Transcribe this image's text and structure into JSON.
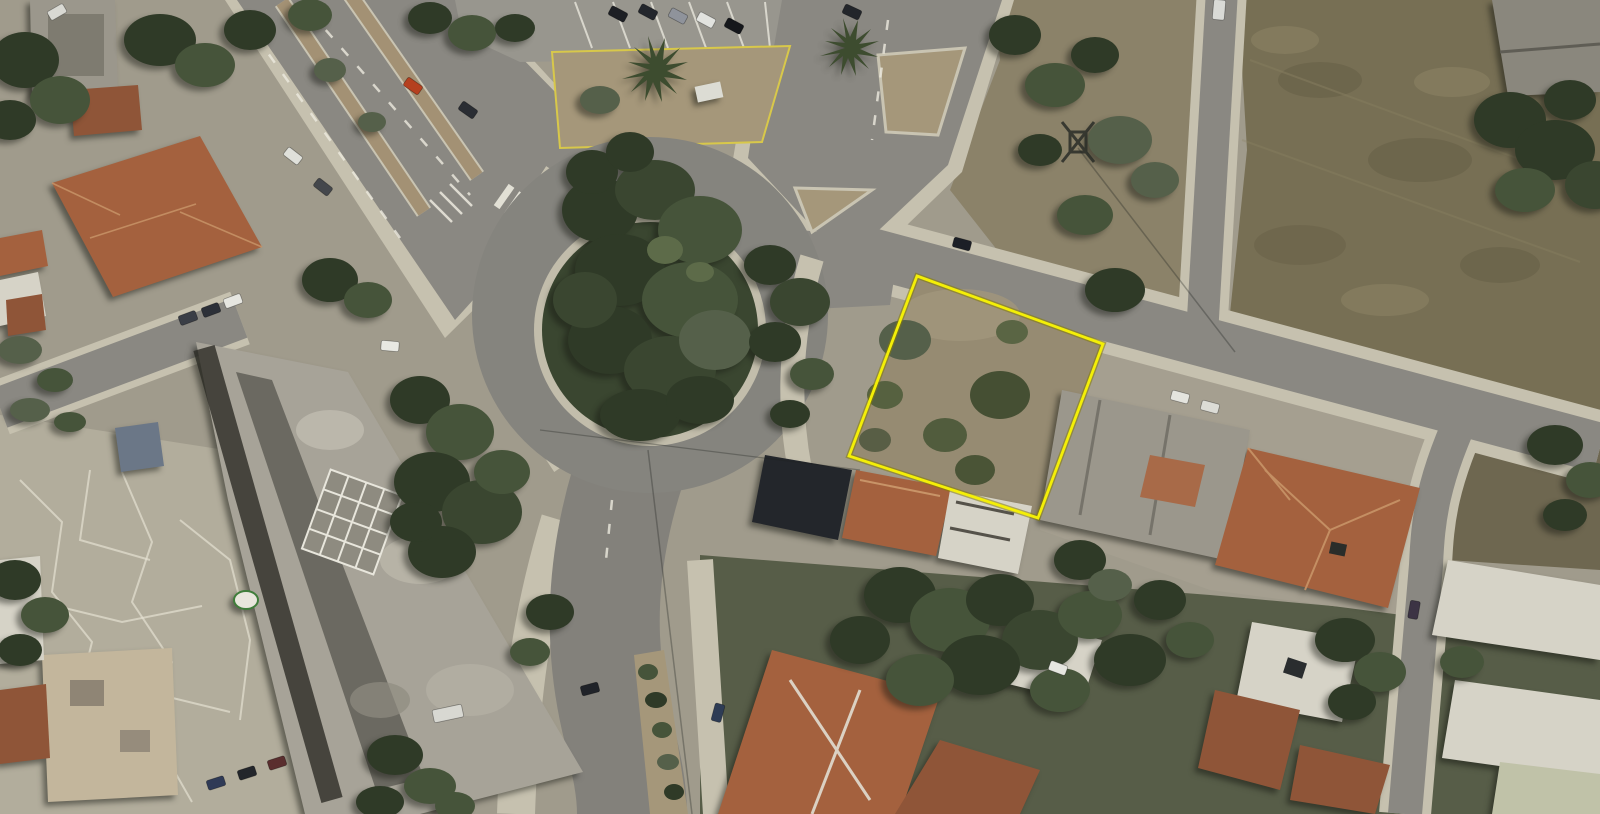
{
  "view": {
    "type": "satellite-aerial-photo",
    "description": "Aerial satellite view of an urban roundabout junction with a vacant land plot highlighted by a yellow boundary line",
    "width_px": 1600,
    "height_px": 814
  },
  "annotation": {
    "plot_boundary": {
      "label": "highlighted vacant land plot",
      "shape": "quadrilateral",
      "points": "917,276 1103,344 1038,518 849,456",
      "stroke_color": "#f4ef07",
      "casing_color": "#857c06",
      "style": "solid-bright-yellow"
    }
  },
  "features": [
    {
      "id": "roundabout",
      "label": "tree-covered roundabout island"
    },
    {
      "id": "highlighted-plot",
      "label": "vacant dirt plot with scattered shrubs outlined in yellow"
    },
    {
      "id": "dry-field",
      "label": "large dry open field, north-east corner"
    },
    {
      "id": "construction-building",
      "label": "large roofless building under construction, south-west"
    },
    {
      "id": "paved-plaza",
      "label": "cracked paved plaza, south-west"
    },
    {
      "id": "boulevard",
      "label": "divided boulevard with planted medians, north-west"
    },
    {
      "id": "north-avenue",
      "label": "wide avenue entering from the north"
    },
    {
      "id": "east-road",
      "label": "road running east past the plot"
    },
    {
      "id": "south-road",
      "label": "road running south with planted median"
    },
    {
      "id": "parking-bays",
      "label": "angled parking bays with cars, top centre"
    },
    {
      "id": "residential-blocks",
      "label": "terracotta-roofed and flat white-roofed houses"
    },
    {
      "id": "parked-cars",
      "label": "cars parked along streets and in yards"
    }
  ],
  "palette": {
    "road": "#8a8882",
    "road_light": "#98968e",
    "sidewalk": "#c6c1af",
    "plaza": "#b2ad9c",
    "field": "#776f54",
    "scrub": "#8b8269",
    "plot_ground": "#968b72",
    "tree_dark": "#2f3a27",
    "tree_mid": "#46543a",
    "tree_light": "#5d6b49",
    "roof_terracotta": "#a4613e",
    "roof_dark": "#23262b",
    "roof_white": "#d6d3c7",
    "concrete": "#a7a398",
    "plot_outline": "#f4ef07"
  }
}
